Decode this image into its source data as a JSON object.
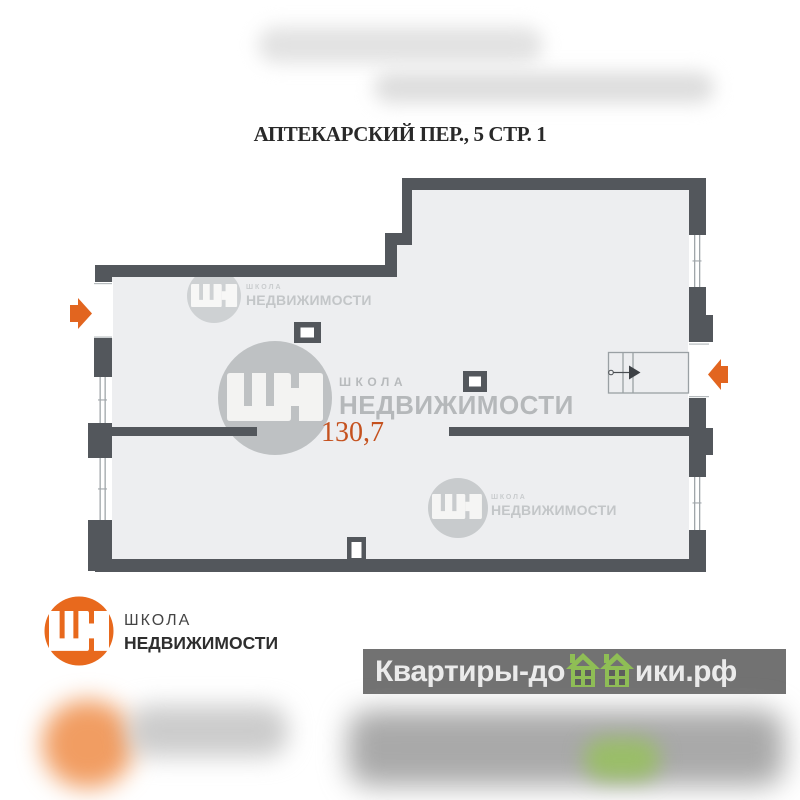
{
  "title": "АПТЕКАРСКИЙ ПЕР., 5 СТР. 1",
  "floor_plan": {
    "area_value": "130,7",
    "colors": {
      "wall": "#53575c",
      "floor": "#edeef0",
      "accent_orange": "#e2651f",
      "area_text": "#c5521f",
      "watermark_gray": "#c2c5c7",
      "site_green": "#8fbe55",
      "band_background": "#5d5d5d"
    }
  },
  "watermarks": {
    "top": {
      "school": "ШКОЛА",
      "realty": "НЕДВИЖИМОСТИ"
    },
    "center": {
      "school": "ШКОЛА",
      "realty": "НЕДВИЖИМОСТИ"
    },
    "lower": {
      "school": "ШКОЛА",
      "realty": "НЕДВИЖИМОСТИ"
    }
  },
  "logo": {
    "school": "ШКОЛА",
    "realty": "НЕДВИЖИМОСТИ"
  },
  "site_band": {
    "prefix": "Квартиры-до",
    "suffix": "ики.рф"
  },
  "icons": {
    "brand": "shn-logo-icon",
    "stairs": "stairs-icon",
    "entry_left": "entry-arrow-left-icon",
    "entry_right": "entry-arrow-right-icon",
    "houses": "green-houses-icon"
  }
}
